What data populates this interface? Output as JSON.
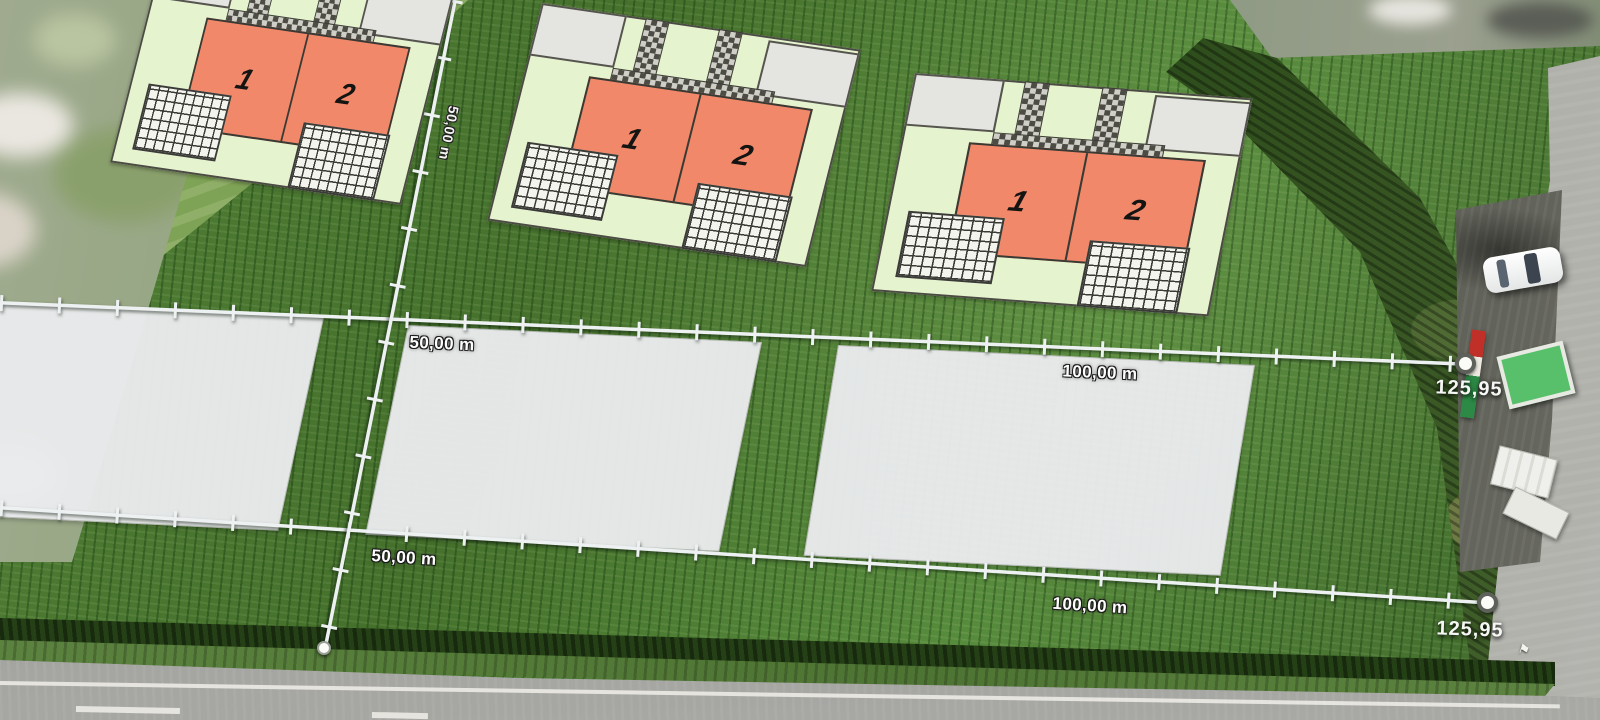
{
  "scene": {
    "description": "aerial-photo-with-site-plan-overlay",
    "colors": {
      "house_fill": "#f2886a",
      "parcel_fill": "#e6f3cf",
      "plot_fill": "#e9eaec",
      "paver_dark": "#4c4c45",
      "measure_line": "#eef1f2",
      "field_green": "#4a7733",
      "table_green": "#58c06a"
    },
    "objects": [
      {
        "name": "white-car"
      },
      {
        "name": "green-table"
      },
      {
        "name": "white-sign-boards"
      },
      {
        "name": "striped-banner"
      },
      {
        "name": "hedge-row"
      },
      {
        "name": "main-road"
      },
      {
        "name": "side-road"
      }
    ]
  },
  "parcels": [
    {
      "name": "duplex-parcel-1",
      "units": [
        {
          "label": "1"
        },
        {
          "label": "2"
        }
      ]
    },
    {
      "name": "duplex-parcel-2",
      "units": [
        {
          "label": "1"
        },
        {
          "label": "2"
        }
      ]
    },
    {
      "name": "duplex-parcel-3",
      "units": [
        {
          "label": "1"
        },
        {
          "label": "2"
        }
      ]
    }
  ],
  "measurements": {
    "upper_line": {
      "first": "50,00 m",
      "second": "100,00 m",
      "total": "125,95"
    },
    "lower_line": {
      "first": "50,00 m",
      "second": "100,00 m",
      "total": "125,95"
    },
    "depth_line": {
      "label": "50,00 m"
    }
  }
}
